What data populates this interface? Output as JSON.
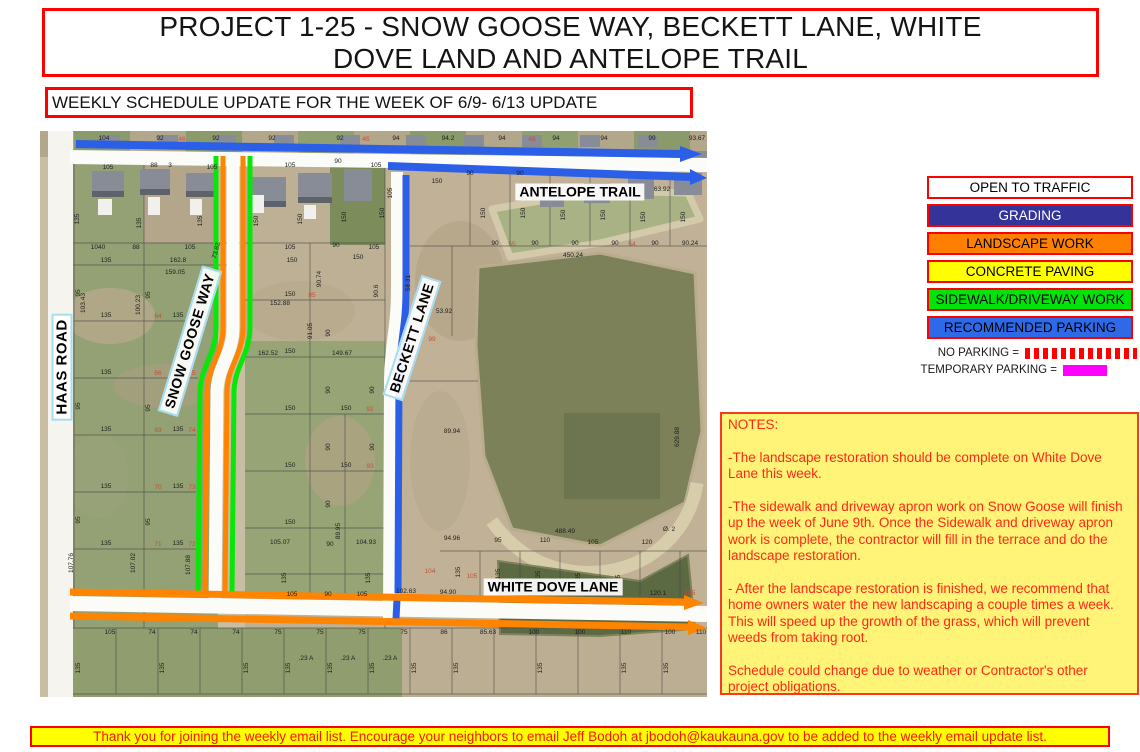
{
  "title": {
    "line1": "PROJECT 1-25 - SNOW GOOSE WAY, BECKETT LANE, WHITE",
    "line2": "DOVE LAND AND ANTELOPE TRAIL"
  },
  "subtitle": "WEEKLY SCHEDULE UPDATE FOR THE WEEK OF 6/9- 6/13 UPDATE",
  "legend": {
    "items": [
      {
        "label": "OPEN TO TRAFFIC",
        "fill": "#ffffff",
        "text": "#000000"
      },
      {
        "label": "GRADING",
        "fill": "#333399",
        "text": "#ffffff"
      },
      {
        "label": "LANDSCAPE WORK",
        "fill": "#ff8000",
        "text": "#000000"
      },
      {
        "label": "CONCRETE PAVING",
        "fill": "#ffff00",
        "text": "#000000"
      },
      {
        "label": "SIDEWALK/DRIVEWAY WORK",
        "fill": "#00e409",
        "text": "#000000"
      },
      {
        "label": "RECOMMENDED PARKING",
        "fill": "#2e6ae8",
        "text": "#000000"
      }
    ],
    "no_parking_label": "NO PARKING =",
    "temporary_parking_label": "TEMPORARY PARKING =",
    "no_parking_swatch": "red-white-striped",
    "temporary_parking_color": "#ff00ff"
  },
  "map": {
    "street_labels": {
      "haas": "HAAS ROAD",
      "snow_goose": "SNOW GOOSE WAY",
      "beckett": "BECKETT LANE",
      "antelope": "ANTELOPE TRAIL",
      "white_dove": "WHITE DOVE LANE"
    },
    "overlay_colors": {
      "open_road": "#fbfbf8",
      "grading": "#333399",
      "landscape": "#ff8400",
      "concrete": "#ffff00",
      "sidewalk": "#0ae50a",
      "parking": "#2b5fe8"
    },
    "parcel_numbers": [
      [
        64,
        9,
        "104"
      ],
      [
        120,
        9,
        "92"
      ],
      [
        176,
        9,
        "92"
      ],
      [
        232,
        9,
        "92"
      ],
      [
        300,
        9,
        "92"
      ],
      [
        356,
        9,
        "94"
      ],
      [
        408,
        9,
        "94.2"
      ],
      [
        462,
        9,
        "94"
      ],
      [
        516,
        9,
        "94"
      ],
      [
        564,
        9,
        "94"
      ],
      [
        612,
        9,
        "99"
      ],
      [
        657,
        9,
        "93.67"
      ],
      [
        142,
        10,
        "46",
        0,
        "r"
      ],
      [
        326,
        10,
        "45",
        0,
        "r"
      ],
      [
        492,
        10,
        "46",
        0,
        "r"
      ],
      [
        68,
        38,
        "105"
      ],
      [
        114,
        36,
        "88"
      ],
      [
        130,
        36,
        "3"
      ],
      [
        172,
        38,
        "105"
      ],
      [
        250,
        36,
        "105"
      ],
      [
        298,
        32,
        "90"
      ],
      [
        336,
        36,
        "105"
      ],
      [
        39,
        88,
        "135",
        -90
      ],
      [
        101,
        92,
        "135",
        -90
      ],
      [
        162,
        90,
        "135",
        -90
      ],
      [
        218,
        90,
        "150",
        -90
      ],
      [
        262,
        88,
        "150",
        -90
      ],
      [
        306,
        86,
        "150",
        -90
      ],
      [
        344,
        82,
        "150",
        -90
      ],
      [
        58,
        118,
        "1040"
      ],
      [
        96,
        118,
        "88"
      ],
      [
        150,
        118,
        "105"
      ],
      [
        250,
        118,
        "105"
      ],
      [
        296,
        116,
        "90"
      ],
      [
        334,
        118,
        "105"
      ],
      [
        66,
        131,
        "135"
      ],
      [
        138,
        131,
        "162.8"
      ],
      [
        252,
        131,
        "150"
      ],
      [
        318,
        128,
        "150"
      ],
      [
        45,
        172,
        "103.43",
        -90
      ],
      [
        100,
        174,
        "100.23",
        -90
      ],
      [
        135,
        143,
        "159.05"
      ],
      [
        178,
        120,
        "73.82",
        -75
      ],
      [
        66,
        186,
        "135"
      ],
      [
        66,
        243,
        "135"
      ],
      [
        66,
        300,
        "135"
      ],
      [
        66,
        357,
        "135"
      ],
      [
        66,
        414,
        "135"
      ],
      [
        138,
        186,
        "135"
      ],
      [
        138,
        243,
        "135"
      ],
      [
        138,
        300,
        "135"
      ],
      [
        138,
        357,
        "135"
      ],
      [
        138,
        414,
        "135"
      ],
      [
        118,
        187,
        "64",
        0,
        "r"
      ],
      [
        118,
        244,
        "66",
        0,
        "r"
      ],
      [
        118,
        301,
        "69",
        0,
        "r"
      ],
      [
        118,
        358,
        "70",
        0,
        "r"
      ],
      [
        118,
        415,
        "71",
        0,
        "r"
      ],
      [
        152,
        187,
        "76",
        0,
        "r"
      ],
      [
        152,
        244,
        "75",
        0,
        "r"
      ],
      [
        152,
        301,
        "74",
        0,
        "r"
      ],
      [
        152,
        358,
        "73",
        0,
        "r"
      ],
      [
        152,
        415,
        "72",
        0,
        "r"
      ],
      [
        40,
        162,
        "95",
        -90
      ],
      [
        110,
        164,
        "95",
        -90
      ],
      [
        40,
        275,
        "95",
        -90
      ],
      [
        110,
        277,
        "95",
        -90
      ],
      [
        40,
        389,
        "95",
        -90
      ],
      [
        110,
        391,
        "95",
        -90
      ],
      [
        33,
        432,
        "107.76",
        -90
      ],
      [
        95,
        432,
        "107.02",
        -90
      ],
      [
        150,
        434,
        "107.88",
        -90
      ],
      [
        240,
        174,
        "152.88"
      ],
      [
        228,
        224,
        "162.52"
      ],
      [
        302,
        224,
        "149.67"
      ],
      [
        272,
        200,
        "91.05",
        -90
      ],
      [
        281,
        148,
        "90.74",
        -90
      ],
      [
        338,
        160,
        "90.6",
        -90
      ],
      [
        250,
        165,
        "150"
      ],
      [
        250,
        222,
        "150"
      ],
      [
        250,
        279,
        "150"
      ],
      [
        250,
        336,
        "150"
      ],
      [
        250,
        393,
        "150"
      ],
      [
        306,
        279,
        "150"
      ],
      [
        306,
        336,
        "150"
      ],
      [
        290,
        202,
        "90",
        -90
      ],
      [
        290,
        259,
        "90",
        -90
      ],
      [
        290,
        316,
        "90",
        -90
      ],
      [
        334,
        259,
        "90",
        -90
      ],
      [
        334,
        316,
        "90",
        -90
      ],
      [
        290,
        373,
        "90",
        -90
      ],
      [
        272,
        166,
        "85",
        0,
        "r"
      ],
      [
        330,
        280,
        "92",
        0,
        "r"
      ],
      [
        330,
        337,
        "93",
        0,
        "r"
      ],
      [
        300,
        400,
        "89.95",
        -90
      ],
      [
        240,
        413,
        "105.07"
      ],
      [
        290,
        415,
        "90"
      ],
      [
        326,
        413,
        "104.93"
      ],
      [
        246,
        447,
        "135",
        -90
      ],
      [
        330,
        447,
        "135",
        -90
      ],
      [
        252,
        465,
        "105"
      ],
      [
        288,
        465,
        "90"
      ],
      [
        322,
        465,
        "105"
      ],
      [
        352,
        62,
        "105",
        -90
      ],
      [
        397,
        52,
        "150"
      ],
      [
        430,
        44,
        "90"
      ],
      [
        480,
        44,
        "90"
      ],
      [
        370,
        152,
        "58.31",
        -90
      ],
      [
        404,
        182,
        "53.92"
      ],
      [
        392,
        210,
        "99",
        0,
        "r"
      ],
      [
        412,
        302,
        "89.94"
      ],
      [
        445,
        82,
        "150",
        -90
      ],
      [
        485,
        82,
        "150",
        -90
      ],
      [
        525,
        84,
        "150",
        -90
      ],
      [
        565,
        84,
        "150",
        -90
      ],
      [
        605,
        86,
        "150",
        -90
      ],
      [
        645,
        86,
        "150",
        -90
      ],
      [
        455,
        114,
        "90"
      ],
      [
        495,
        114,
        "90"
      ],
      [
        535,
        114,
        "90"
      ],
      [
        575,
        114,
        "90"
      ],
      [
        615,
        114,
        "90"
      ],
      [
        650,
        114,
        "90.24"
      ],
      [
        472,
        115,
        "55",
        0,
        "r"
      ],
      [
        592,
        115,
        "54",
        0,
        "r"
      ],
      [
        533,
        126,
        "450.24"
      ],
      [
        622,
        60,
        "63.92"
      ],
      [
        639,
        306,
        "629.88",
        -90
      ],
      [
        525,
        402,
        "488.49"
      ],
      [
        629,
        400,
        "Ø. 2"
      ],
      [
        412,
        409,
        "94.96"
      ],
      [
        458,
        411,
        "95"
      ],
      [
        505,
        411,
        "110"
      ],
      [
        553,
        413,
        "105"
      ],
      [
        607,
        413,
        "120"
      ],
      [
        420,
        441,
        "135",
        -90
      ],
      [
        460,
        443,
        "135",
        -90
      ],
      [
        500,
        445,
        "135",
        -90
      ],
      [
        540,
        447,
        "135",
        -90
      ],
      [
        580,
        449,
        "135",
        -90
      ],
      [
        366,
        462,
        "102.63"
      ],
      [
        408,
        463,
        "94.90"
      ],
      [
        618,
        464,
        "120.1"
      ],
      [
        390,
        442,
        "104",
        0,
        "r"
      ],
      [
        432,
        447,
        "105",
        0,
        "r"
      ],
      [
        650,
        464,
        "105",
        0,
        "r"
      ],
      [
        70,
        503,
        "105"
      ],
      [
        112,
        503,
        "74"
      ],
      [
        154,
        503,
        "74"
      ],
      [
        196,
        503,
        "74"
      ],
      [
        238,
        503,
        "75"
      ],
      [
        280,
        503,
        "75"
      ],
      [
        322,
        503,
        "75"
      ],
      [
        364,
        503,
        "75"
      ],
      [
        404,
        503,
        "86"
      ],
      [
        448,
        503,
        "85.63"
      ],
      [
        494,
        503,
        "100"
      ],
      [
        540,
        503,
        "100"
      ],
      [
        586,
        503,
        "110"
      ],
      [
        630,
        503,
        "100"
      ],
      [
        661,
        503,
        "110"
      ],
      [
        40,
        537,
        "135",
        -90
      ],
      [
        124,
        537,
        "135",
        -90
      ],
      [
        208,
        537,
        "135",
        -90
      ],
      [
        250,
        537,
        "135",
        -90
      ],
      [
        292,
        537,
        "135",
        -90
      ],
      [
        334,
        537,
        "135",
        -90
      ],
      [
        376,
        537,
        "135",
        -90
      ],
      [
        418,
        537,
        "135",
        -90
      ],
      [
        502,
        537,
        "135",
        -90
      ],
      [
        586,
        537,
        "135",
        -90
      ],
      [
        628,
        537,
        "135",
        -90
      ],
      [
        266,
        529,
        ".23 A"
      ],
      [
        308,
        529,
        ".23 A"
      ],
      [
        350,
        529,
        ".23 A"
      ]
    ]
  },
  "notes": {
    "heading": "NOTES:",
    "paragraphs": [
      "-The landscape restoration should be complete on White Dove Lane this week.",
      "-The sidewalk and driveway apron work on Snow Goose will finish up the week of June 9th.  Once the Sidewalk and driveway apron work is complete, the contractor will fill in the terrace and do the landscape restoration.",
      " - After the landscape restoration is finished, we recommend that home owners water the new landscaping a couple times a week.  This will speed up the growth of the grass, which will prevent weeds from taking root.",
      "Schedule could change due to weather or Contractor's other project obligations."
    ]
  },
  "footer": "Thank you for joining the weekly email list. Encourage your neighbors to email Jeff Bodoh at jbodoh@kaukauna.gov to be added to the weekly email update list."
}
